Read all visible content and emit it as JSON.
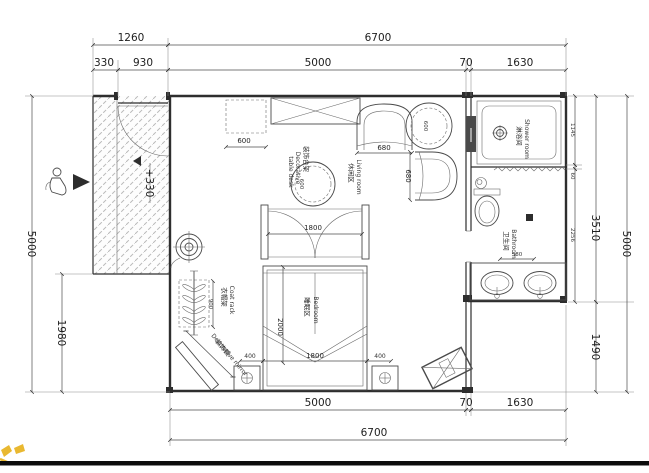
{
  "drawing": {
    "type": "floor-plan"
  },
  "colors": {
    "line": "#2e2e2e",
    "hatch": "#b9b9b9",
    "watermark_yellow": "#e9b830",
    "bottom_bar": "#0c0c0c"
  },
  "dims": {
    "top_1260": "1260",
    "top_6700": "6700",
    "top_330": "330",
    "top_930": "930",
    "top_5000": "5000",
    "top_70": "70",
    "top_1630": "1630",
    "bottom_5000": "5000",
    "bottom_70": "70",
    "bottom_1630": "1630",
    "bottom_6700": "6700",
    "left_5000": "5000",
    "left_1980": "1980",
    "right_1145": "1145",
    "right_60": "60",
    "right_2256": "2256",
    "right_3510": "3510",
    "right_1490": "1490",
    "right_5000": "5000",
    "cabinet_600": "600",
    "table_600": "600",
    "chair_680": "680",
    "stool_600": "600",
    "chair2_680": "680",
    "door_1800": "1800",
    "bed_2000": "2000",
    "bed_1800": "1800",
    "nightstand_left_400": "400",
    "nightstand_right_400": "400",
    "coatrack_900": "900",
    "bath_580": "580",
    "level": "+330"
  },
  "rooms": {
    "shower": {
      "zh": "淋浴间",
      "en": "Shower room"
    },
    "bathroom": {
      "zh": "卫生间",
      "en": "Bathroom"
    },
    "living": {
      "zh": "休闲区",
      "en": "Living room"
    },
    "bedroom": {
      "zh": "睡眠区",
      "en": "Bedroom"
    }
  },
  "annotations": {
    "coat_rack": {
      "zh": "衣帽架",
      "en": "Coat rack"
    },
    "mirror": {
      "zh": "装饰镜",
      "en": "Decorative mirror"
    },
    "deco_table": {
      "zh": "装饰台架",
      "en_1": "Decorative",
      "en_2": "table desk"
    }
  }
}
